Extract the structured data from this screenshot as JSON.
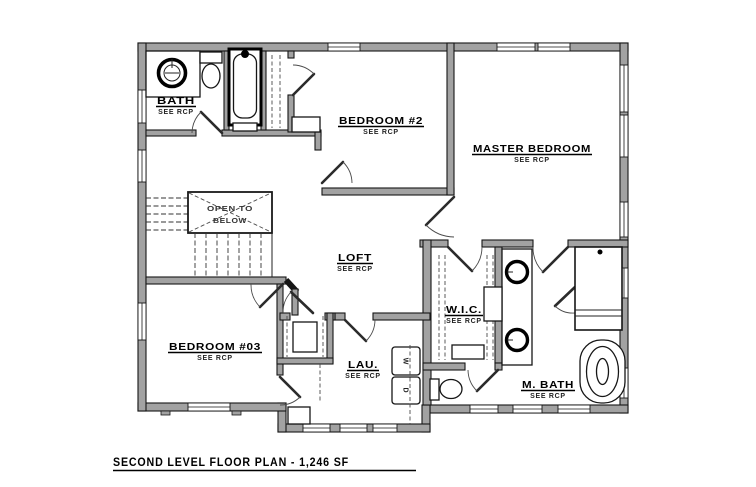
{
  "sheet": {
    "title": "SECOND LEVEL FLOOR PLAN - 1,246 SF"
  },
  "rooms": {
    "bath": {
      "name": "BATH",
      "note": "SEE RCP"
    },
    "bedroom2": {
      "name": "BEDROOM #2",
      "note": "SEE RCP"
    },
    "master": {
      "name": "MASTER BEDROOM",
      "note": "SEE RCP"
    },
    "loft": {
      "name": "LOFT",
      "note": "SEE RCP"
    },
    "bedroom03": {
      "name": "BEDROOM #03",
      "note": "SEE RCP"
    },
    "wic": {
      "name": "W.I.C.",
      "note": "SEE RCP"
    },
    "laundry": {
      "name": "LAU.",
      "note": "SEE RCP"
    },
    "mbath": {
      "name": "M. BATH",
      "note": "SEE RCP"
    }
  },
  "annotations": {
    "open_to_below_line1": "OPEN TO",
    "open_to_below_line2": "BELOW"
  },
  "appliances": {
    "washer": "W",
    "dryer": "D"
  },
  "colors": {
    "wall_fill": "#a2a2a2",
    "line": "#161616",
    "background": "#ffffff"
  }
}
